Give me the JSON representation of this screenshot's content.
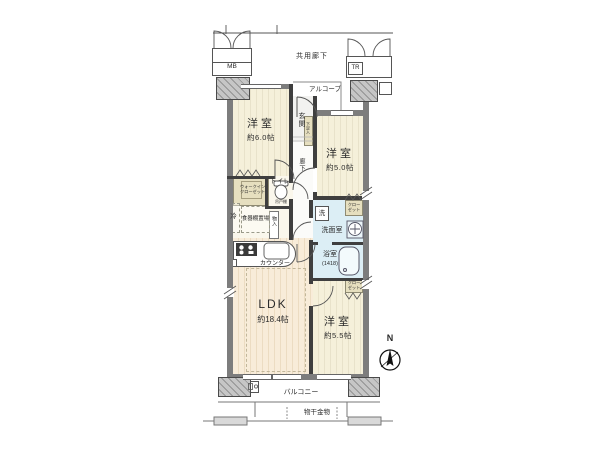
{
  "plan_type": "apartment-floor-plan",
  "labels": {
    "common_corridor": "共用廊下",
    "alcove": "アルコーブ",
    "mb": "MB",
    "tr": "TR",
    "entrance": "玄関",
    "corridor": "廊下",
    "shoe_cabinet": "下足入",
    "room_1": {
      "name": "洋室",
      "size": "約6.0帖"
    },
    "room_2": {
      "name": "洋室",
      "size": "約5.0帖"
    },
    "room_3": {
      "name": "洋室",
      "size": "約5.5帖"
    },
    "ldk": {
      "name": "LDK",
      "size": "約18.4帖"
    },
    "walk_in_closet": {
      "line1": "ウォークイン",
      "line2": "クローゼット"
    },
    "closet": {
      "line1": "クロー",
      "line2": "ゼット"
    },
    "toilet": "トイレ",
    "hanging_cupboard": "吊戸棚",
    "storage": "物入",
    "refrigerator": "冷",
    "cupboard_space": "食器棚置場",
    "counter": "カウンター",
    "laundry": "洗",
    "washroom": "洗面室",
    "bathroom": {
      "name": "浴室",
      "size": "(1418)"
    },
    "balcony": "バルコニー",
    "drying_hardware": "物干金物",
    "compass_north": "N"
  },
  "colors": {
    "outer_wall": "#7d7d7d",
    "inner_wall": "#3f3f3f",
    "room_floor": "#f5f0da",
    "ldk_floor": "#f8ecd9",
    "wet_area": "#dceef5",
    "closet_fill": "#e6dfbf",
    "column_hatch": "#949494"
  }
}
